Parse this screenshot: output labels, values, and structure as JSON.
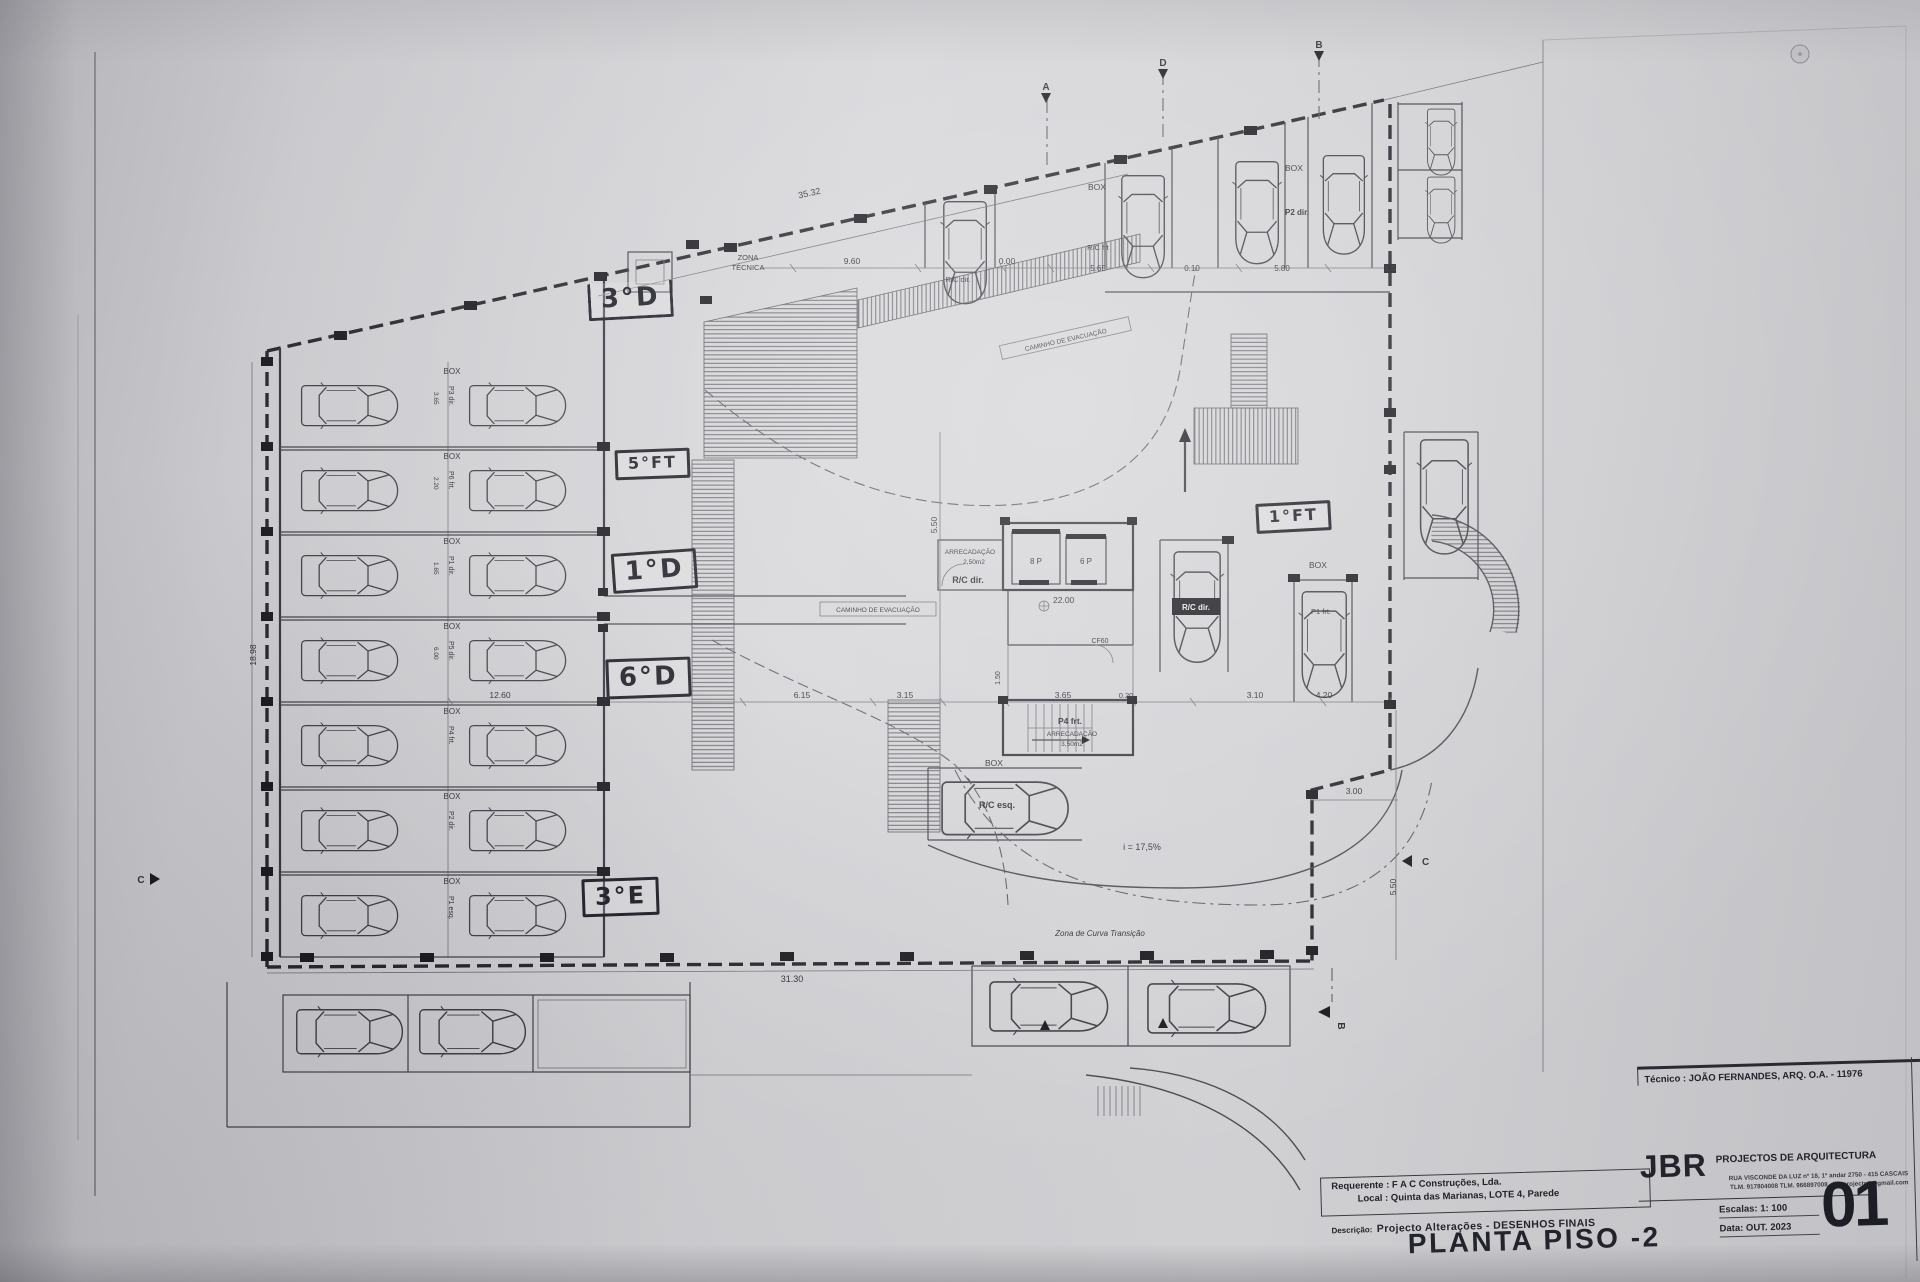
{
  "colors": {
    "paper": "#d2d2d5",
    "ink": "#3f3f47",
    "boundary_ink": "#23232b",
    "marker_ink": "#191922"
  },
  "sheet": {
    "handwritten": {
      "apt_3d": "3°D",
      "apt_5ft": "5°FT",
      "apt_1d": "1°D",
      "apt_6d": "6°D",
      "apt_3e": "3°E",
      "apt_1ft": "1°FT"
    },
    "plan": {
      "zona_tecnica_1": "ZONA",
      "zona_tecnica_2": "TÉCNICA",
      "caminho_evac_1": "CAMINHO DE EVACUAÇÃO",
      "caminho_evac_2": "CAMINHO DE EVACUAÇÃO",
      "box": "BOX",
      "rc_dir_top": "R/C dir.",
      "rc_frt": "R/C frt",
      "p2_dir": "P2 dir.",
      "p1_frt": "P1 frt.",
      "rc_dir_badge": "R/C dir.",
      "rc_esq": "R/C esq.",
      "arrec_store_1": "ARRECADAÇÃO",
      "arrec_store_1_area": "2,50m2",
      "rc_dir_store": "R/C dir.",
      "elev_left": "8 P",
      "elev_right": "6 P",
      "level_mark": "22.00",
      "cf60": "CF60",
      "stair_owner": "P4 frt.",
      "arrec_store_2": "ARRECADAÇÃO",
      "arrec_store_2_area": "3,50m2",
      "ramp_slope": "i = 17,5%",
      "curva_transicao": "Zona de Curva Transição"
    },
    "left_rows": [
      {
        "box": "BOX",
        "p": "P3 dir.",
        "dim": "3.65"
      },
      {
        "box": "BOX",
        "p": "P6 frt.",
        "dim": "2.20"
      },
      {
        "box": "BOX",
        "p": "P1 dir.",
        "dim": "1.65"
      },
      {
        "box": "BOX",
        "p": "P5 dir.",
        "dim": "6.00"
      },
      {
        "box": "BOX",
        "p": "P4 frt.",
        "dim": ""
      },
      {
        "box": "BOX",
        "p": "P2 dir.",
        "dim": ""
      },
      {
        "box": "BOX",
        "p": "P1 esq.",
        "dim": ""
      }
    ],
    "dims": {
      "d3532": "35.32",
      "d960": "9.60",
      "d000": "0.00",
      "d565": "5.65",
      "d010": "0.10",
      "d580": "5.80",
      "d15": "1.5",
      "d1898": "18.98",
      "d1260": "12.60",
      "d615": "6.15",
      "d315": "3.15",
      "d365": "3.65",
      "d020": "0.20",
      "d310": "3.10",
      "d420": "4.20",
      "d550a": "5.50",
      "d150": "1.50",
      "d300": "3.00",
      "d550b": "5.50",
      "d3130": "31.30"
    },
    "sections": {
      "a_top": "A",
      "d_top": "D",
      "b_top": "B",
      "c_left": "C",
      "c_right": "C",
      "b_bottom": "B"
    }
  },
  "title_block": {
    "tecnico": "Técnico : JOÃO FERNANDES, ARQ.   O.A. - 11976",
    "requerente": "Requerente : F A C  Construções, Lda.",
    "local": "Local : Quinta das Marianas, LOTE 4, Parede",
    "descricao_label": "Descrição:",
    "descricao": "Projecto Alterações - DESENHOS FINAIS",
    "drawing_title": "PLANTA PISO -2",
    "firm_initials": "JBR",
    "firm_name": "PROJECTOS DE ARQUITECTURA",
    "firm_address": "RUA VISCONDE DA LUZ nº 18, 1º andar  2750 - 415  CASCAIS",
    "firm_contacts": "TLM. 917804008  TLM. 966897008 - jbr.projectos@gmail.com",
    "escalas": "Escalas:  1: 100",
    "data": "Data: OUT.  2023",
    "sheet_number": "01"
  }
}
